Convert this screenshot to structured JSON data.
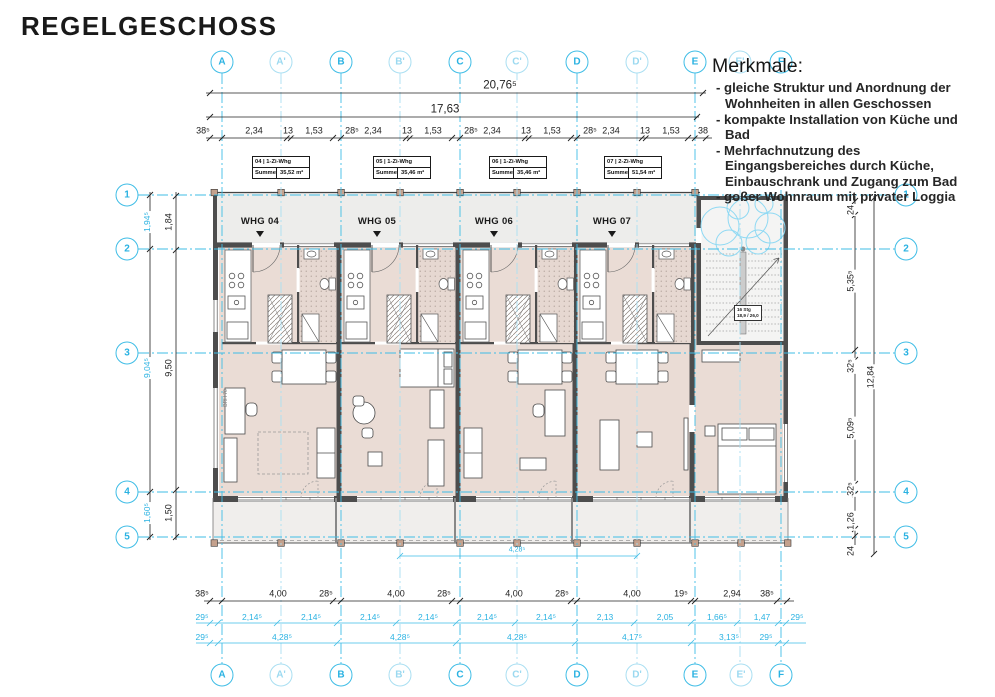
{
  "title": "REGELGESCHOSS",
  "merkmale": {
    "heading": "Merkmale:",
    "items": [
      "- gleiche Struktur und Anordnung der Wohnheiten in allen Geschossen",
      "- kompakte Installation von Küche und Bad",
      "- Mehrfachnutzung des Eingangsbereiches durch Küche, Einbauschrank und Zugang zum Bad",
      "- goßer Wohnraum mit privater Loggia"
    ]
  },
  "apartments": [
    {
      "whg": "WHG 04",
      "unit": "04 | 1-Zi-Whg",
      "summe_label": "Summe",
      "area": "35,52 m²"
    },
    {
      "whg": "WHG 05",
      "unit": "05 | 1-Zi-Whg",
      "summe_label": "Summe",
      "area": "35,46 m²"
    },
    {
      "whg": "WHG 06",
      "unit": "06 | 1-Zi-Whg",
      "summe_label": "Summe",
      "area": "35,46 m²"
    },
    {
      "whg": "WHG 07",
      "unit": "07 | 2-Zi-Whg",
      "summe_label": "Summe",
      "area": "51,54 m²"
    }
  ],
  "axes": {
    "letters": [
      "A",
      "A'",
      "B",
      "B'",
      "C",
      "C'",
      "D",
      "D'",
      "E",
      "E'",
      "F"
    ],
    "numbers": [
      "1",
      "2",
      "3",
      "4",
      "5"
    ]
  },
  "dims": {
    "total_top": "20,76⁵",
    "total_mid": "17,63",
    "top_row": [
      "38⁵",
      "2,34",
      "13",
      "1,53",
      "28⁵",
      "2,34",
      "13",
      "1,53",
      "28⁵",
      "2,34",
      "13",
      "1,53",
      "28⁵",
      "2,34",
      "13",
      "1,53",
      "38"
    ],
    "bottom_row1": [
      "38⁵",
      "4,00",
      "28⁵",
      "4,00",
      "28⁵",
      "4,00",
      "28⁵",
      "4,00",
      "19⁵",
      "2,94",
      "38⁵"
    ],
    "bottom_row2": [
      "29⁵",
      "2,14⁵",
      "2,14⁵",
      "2,14⁵",
      "2,14⁵",
      "2,14⁵",
      "2,14⁵",
      "2,13",
      "2,05",
      "1,66⁵",
      "1,47",
      "29⁵"
    ],
    "bottom_row3": [
      "29⁵",
      "4,28⁵",
      "4,28⁵",
      "4,28⁵",
      "4,17⁵",
      "3,13⁵",
      "29⁵"
    ],
    "left_outer": [
      "1,94⁵",
      "9,04⁵",
      "1,60⁵"
    ],
    "left_inner": [
      "1,84",
      "9,50",
      "1,50"
    ],
    "right_inner": [
      "24",
      "5,35⁵",
      "32⁵",
      "5,09⁵",
      "32⁵",
      "1,26",
      "24"
    ],
    "right_total": "12,84",
    "balcony": "4,28⁵"
  },
  "stairs": {
    "line1": "16 Stg",
    "line2": "18,9 / 26,0"
  },
  "annotations": {
    "brh": "BRH 70"
  },
  "colors": {
    "accent": "#3fbde6",
    "accent_light": "#aadff2",
    "room": "#eadcd5",
    "common": "#ededeb",
    "wall": "#4d4d4d",
    "post": "#c4a18d"
  }
}
